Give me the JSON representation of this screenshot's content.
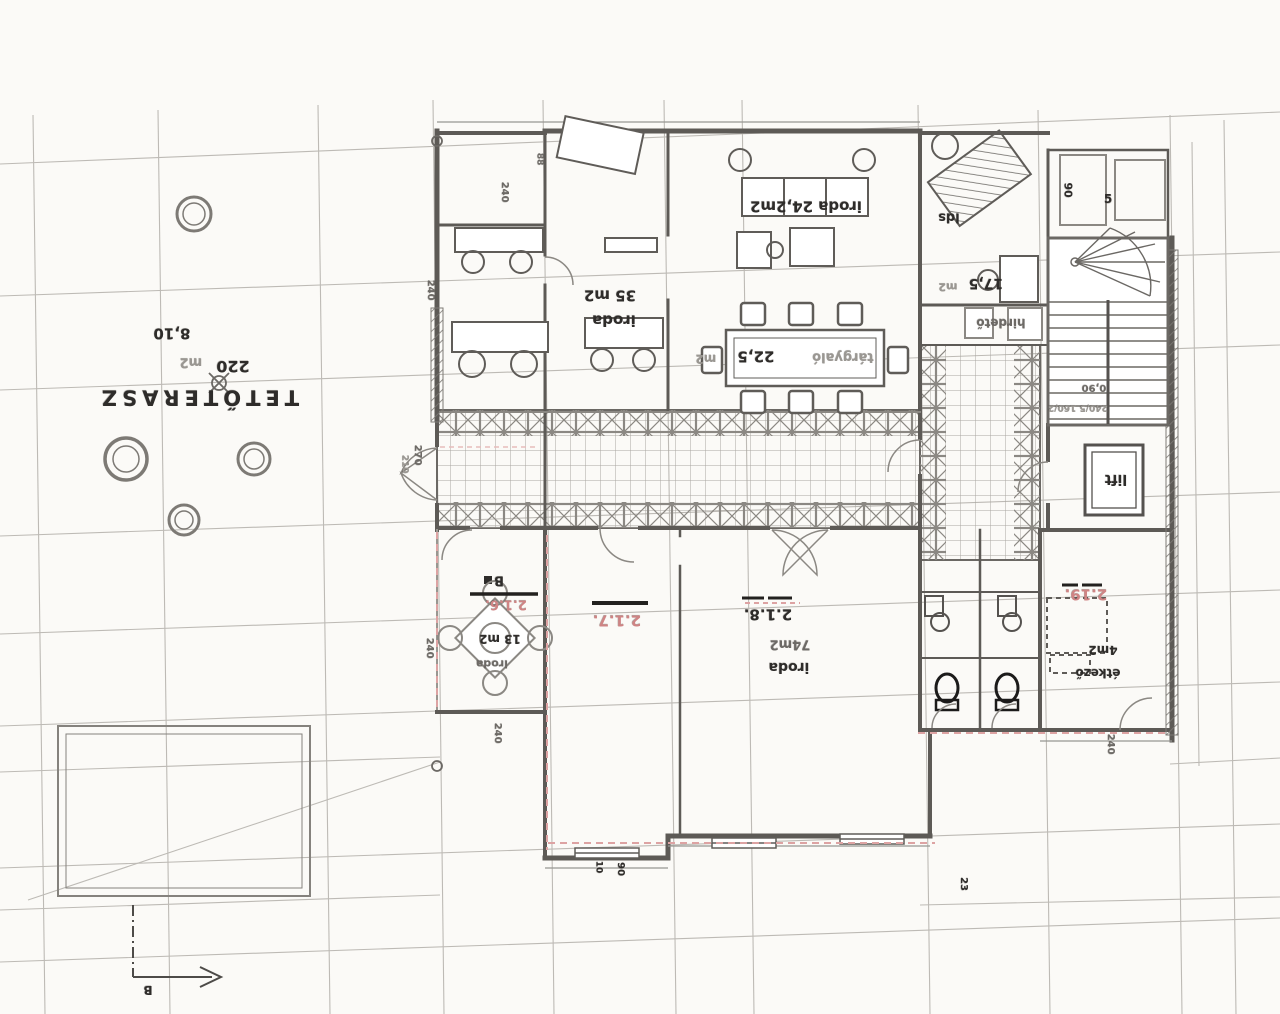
{
  "colors": {
    "ink": "#2e2c2a",
    "mid": "#6d6a66",
    "faint": "#9a9792",
    "red": "#cf8484",
    "paper": "#fbfaf7",
    "grid": "#b3b0aa",
    "wall": "#5d5a56",
    "pink_dash": "#dda3a3"
  },
  "drawing": {
    "type": "scanned architectural floor plan, rotated 180 degrees",
    "terrace_name": "TETŐTERASZ",
    "terrace_area": "220 m2"
  },
  "labels": [
    {
      "id": "tetoterasz",
      "text": "TETŐTERASZ",
      "x": 198,
      "y": 397,
      "rot": 180,
      "size": 21,
      "ls": 5,
      "color": "ink",
      "weight": 700
    },
    {
      "id": "terasz-area-value",
      "text": "220",
      "x": 233,
      "y": 366,
      "rot": 180,
      "size": 16,
      "color": "ink",
      "weight": 700
    },
    {
      "id": "terasz-area-unit",
      "text": "m2",
      "x": 191,
      "y": 362,
      "rot": 180,
      "size": 13,
      "color": "faint",
      "weight": 600
    },
    {
      "id": "dim-810",
      "text": "8,10",
      "x": 172,
      "y": 333,
      "rot": 180,
      "size": 15,
      "color": "ink",
      "weight": 700
    },
    {
      "id": "iroda35-area",
      "text": "35 m2",
      "x": 610,
      "y": 295,
      "rot": 180,
      "size": 15,
      "color": "ink",
      "weight": 700
    },
    {
      "id": "iroda35-name",
      "text": "iroda",
      "x": 614,
      "y": 320,
      "rot": 180,
      "size": 15,
      "color": "ink",
      "weight": 700
    },
    {
      "id": "iroda242",
      "text": "iroda 24,2m2",
      "x": 806,
      "y": 206,
      "rot": 180,
      "size": 15,
      "color": "ink",
      "weight": 700
    },
    {
      "id": "targyalo-name",
      "text": "tárgyaló",
      "x": 843,
      "y": 357,
      "rot": 180,
      "size": 13,
      "color": "faint",
      "weight": 600
    },
    {
      "id": "targyalo-area",
      "text": "22,5",
      "x": 756,
      "y": 356,
      "rot": 180,
      "size": 15,
      "color": "ink",
      "weight": 700
    },
    {
      "id": "targyalo-unit",
      "text": "m2",
      "x": 706,
      "y": 359,
      "rot": 180,
      "size": 12,
      "color": "faint",
      "weight": 600
    },
    {
      "id": "lds",
      "text": "lds",
      "x": 949,
      "y": 217,
      "rot": 180,
      "size": 13,
      "color": "ink",
      "weight": 700
    },
    {
      "id": "room175-area",
      "text": "17,5",
      "x": 986,
      "y": 283,
      "rot": 180,
      "size": 14,
      "color": "ink",
      "weight": 700
    },
    {
      "id": "room175-unit",
      "text": "m2",
      "x": 948,
      "y": 287,
      "rot": 180,
      "size": 11,
      "color": "faint",
      "weight": 600
    },
    {
      "id": "hirdeto",
      "text": "hirdető",
      "x": 1001,
      "y": 323,
      "rot": 180,
      "size": 12,
      "color": "mid",
      "weight": 700
    },
    {
      "id": "lift",
      "text": "lift",
      "x": 1116,
      "y": 479,
      "rot": 180,
      "size": 14,
      "color": "ink",
      "weight": 700
    },
    {
      "id": "dim-090",
      "text": "0,90",
      "x": 1094,
      "y": 387,
      "rot": 180,
      "size": 10,
      "color": "mid",
      "weight": 600
    },
    {
      "id": "dim-240-160",
      "text": "240/5  160/2",
      "x": 1078,
      "y": 407,
      "rot": 180,
      "size": 9,
      "color": "faint",
      "weight": 600
    },
    {
      "id": "room219-num",
      "text": "2.19.",
      "x": 1086,
      "y": 594,
      "rot": 180,
      "size": 15,
      "color": "red",
      "weight": 700
    },
    {
      "id": "etkezo-area",
      "text": "4m2",
      "x": 1103,
      "y": 650,
      "rot": 180,
      "size": 12,
      "color": "ink",
      "weight": 700
    },
    {
      "id": "etkezo-name",
      "text": "étkező",
      "x": 1098,
      "y": 673,
      "rot": 180,
      "size": 12,
      "color": "ink",
      "weight": 700
    },
    {
      "id": "room218-num",
      "text": "2.1.8.",
      "x": 768,
      "y": 614,
      "rot": 180,
      "size": 15,
      "color": "ink",
      "weight": 700
    },
    {
      "id": "iroda74-area",
      "text": "74m2",
      "x": 790,
      "y": 644,
      "rot": 180,
      "size": 13,
      "color": "mid",
      "weight": 600
    },
    {
      "id": "iroda74-name",
      "text": "iroda",
      "x": 789,
      "y": 667,
      "rot": 180,
      "size": 14,
      "color": "ink",
      "weight": 700
    },
    {
      "id": "room217-num",
      "text": "2.1.7.",
      "x": 617,
      "y": 620,
      "rot": 180,
      "size": 15,
      "color": "red",
      "weight": 700
    },
    {
      "id": "room216-num",
      "text": "2.1.6.",
      "x": 506,
      "y": 604,
      "rot": 180,
      "size": 13,
      "color": "red",
      "weight": 700
    },
    {
      "id": "iroda13-area",
      "text": "13 m2",
      "x": 500,
      "y": 639,
      "rot": 180,
      "size": 12,
      "color": "ink",
      "weight": 700
    },
    {
      "id": "iroda13-name",
      "text": "iroda",
      "x": 492,
      "y": 664,
      "rot": 180,
      "size": 11,
      "color": "mid",
      "weight": 600
    },
    {
      "id": "marker-b-top",
      "text": "B",
      "x": 499,
      "y": 580,
      "rot": 180,
      "size": 13,
      "color": "ink",
      "weight": 700
    },
    {
      "id": "marker-b-bottom",
      "text": "B",
      "x": 148,
      "y": 990,
      "rot": 180,
      "size": 12,
      "color": "ink",
      "weight": 700
    },
    {
      "id": "dim-240-a",
      "text": "240",
      "x": 504,
      "y": 192,
      "rot": 90,
      "size": 10,
      "color": "mid",
      "weight": 600
    },
    {
      "id": "dim-88",
      "text": "88",
      "x": 539,
      "y": 159,
      "rot": 90,
      "size": 9,
      "color": "mid",
      "weight": 600
    },
    {
      "id": "dim-240-b",
      "text": "240",
      "x": 430,
      "y": 290,
      "rot": 90,
      "size": 10,
      "color": "mid",
      "weight": 600
    },
    {
      "id": "dim-270",
      "text": "270",
      "x": 417,
      "y": 455,
      "rot": 90,
      "size": 10,
      "color": "mid",
      "weight": 600
    },
    {
      "id": "dim-210",
      "text": "210",
      "x": 404,
      "y": 464,
      "rot": 90,
      "size": 9,
      "color": "faint",
      "weight": 600
    },
    {
      "id": "dim-240-c",
      "text": "240",
      "x": 429,
      "y": 648,
      "rot": 90,
      "size": 10,
      "color": "mid",
      "weight": 600
    },
    {
      "id": "dim-240-d",
      "text": "240",
      "x": 497,
      "y": 733,
      "rot": 90,
      "size": 10,
      "color": "mid",
      "weight": 600
    },
    {
      "id": "dim-10",
      "text": "10",
      "x": 598,
      "y": 867,
      "rot": 90,
      "size": 9,
      "color": "ink",
      "weight": 700
    },
    {
      "id": "dim-90-a",
      "text": "90",
      "x": 620,
      "y": 869,
      "rot": 90,
      "size": 10,
      "color": "ink",
      "weight": 700
    },
    {
      "id": "dim-23",
      "text": "23",
      "x": 963,
      "y": 884,
      "rot": 90,
      "size": 10,
      "color": "ink",
      "weight": 700
    },
    {
      "id": "dim-240-e",
      "text": "240",
      "x": 1110,
      "y": 744,
      "rot": 90,
      "size": 10,
      "color": "mid",
      "weight": 600
    },
    {
      "id": "dim-90-b",
      "text": "90",
      "x": 1068,
      "y": 190,
      "rot": 90,
      "size": 11,
      "color": "ink",
      "weight": 700
    },
    {
      "id": "dim-5",
      "text": "5",
      "x": 1108,
      "y": 199,
      "rot": 0,
      "size": 12,
      "color": "ink",
      "weight": 700
    }
  ]
}
